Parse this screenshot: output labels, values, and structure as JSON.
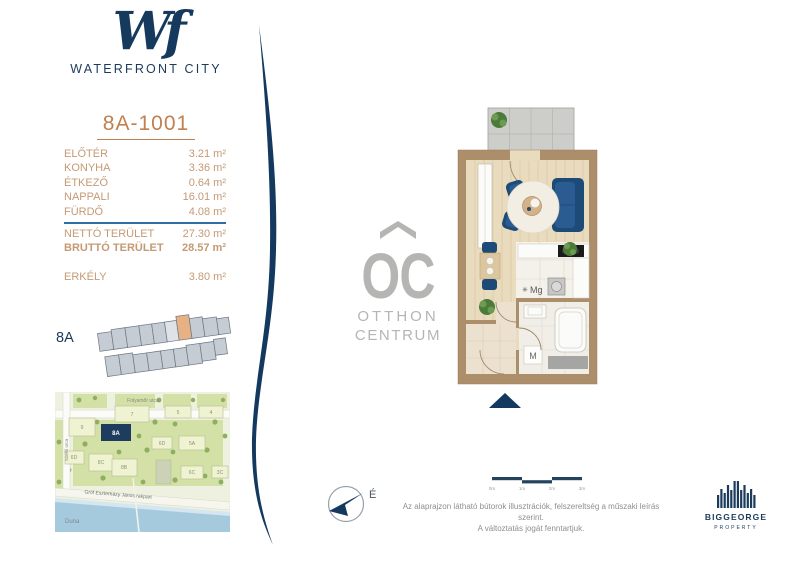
{
  "brand": {
    "monogram": "Wf",
    "name": "WATERFRONT CITY"
  },
  "unit": {
    "id": "8A-1001",
    "rooms": [
      {
        "label": "ELŐTÉR",
        "area": "3.21 m²"
      },
      {
        "label": "KONYHA",
        "area": "3.36 m²"
      },
      {
        "label": "ÉTKEZŐ",
        "area": "0.64 m²"
      },
      {
        "label": "NAPPALI",
        "area": "16.01 m²"
      },
      {
        "label": "FÜRDŐ",
        "area": "4.08 m²"
      }
    ],
    "totals": {
      "netto": {
        "label": "NETTÓ TERÜLET",
        "area": "27.30 m²"
      },
      "brutto": {
        "label": "BRUTTÓ TERÜLET",
        "area": "28.57 m²"
      }
    },
    "balcony": {
      "label": "ERKÉLY",
      "area": "3.80 m²"
    }
  },
  "floor_overview": {
    "label": "8A"
  },
  "site_map": {
    "street_top": "Folyamőr utca",
    "street_left": "Szellő utca",
    "embankment": "Gróf Eszterházy János rakpart",
    "river": "Duna",
    "buildings": {
      "b9": "9",
      "b7": "7",
      "b5": "5",
      "b4": "4",
      "b8a": "8A",
      "b6d1": "6D",
      "b5a": "5A",
      "b6d2": "6D",
      "b8c": "8C",
      "b8b": "8B",
      "b6c": "6C",
      "b3c": "3C"
    }
  },
  "floorplan": {
    "washer_note": "✳",
    "washer_label": "Mg",
    "m_label": "M"
  },
  "watermark": {
    "monogram": "OC",
    "line1": "OTTHON",
    "line2": "CENTRUM"
  },
  "compass": {
    "north": "É"
  },
  "scale_bar": {
    "ticks": [
      "0m",
      "1m",
      "2m",
      "3m"
    ]
  },
  "disclaimer": {
    "line1": "Az alaprajzon látható bútorok illusztrációk, felszereltség a műszaki leírás szerint.",
    "line2": "A változtatás jogát fenntartjuk."
  },
  "developer": {
    "name": "BIGGEORGE",
    "division": "PROPERTY"
  },
  "colors": {
    "navy": "#16395e",
    "accent": "#c0804f",
    "table_text": "#c49a74",
    "divider_blue": "#2f6ea5",
    "wall_tan": "#ad8e6b",
    "watermark_gray": "#b5b5b3",
    "river_blue": "#a6cadd",
    "highlight_unit": "#e8b184"
  }
}
